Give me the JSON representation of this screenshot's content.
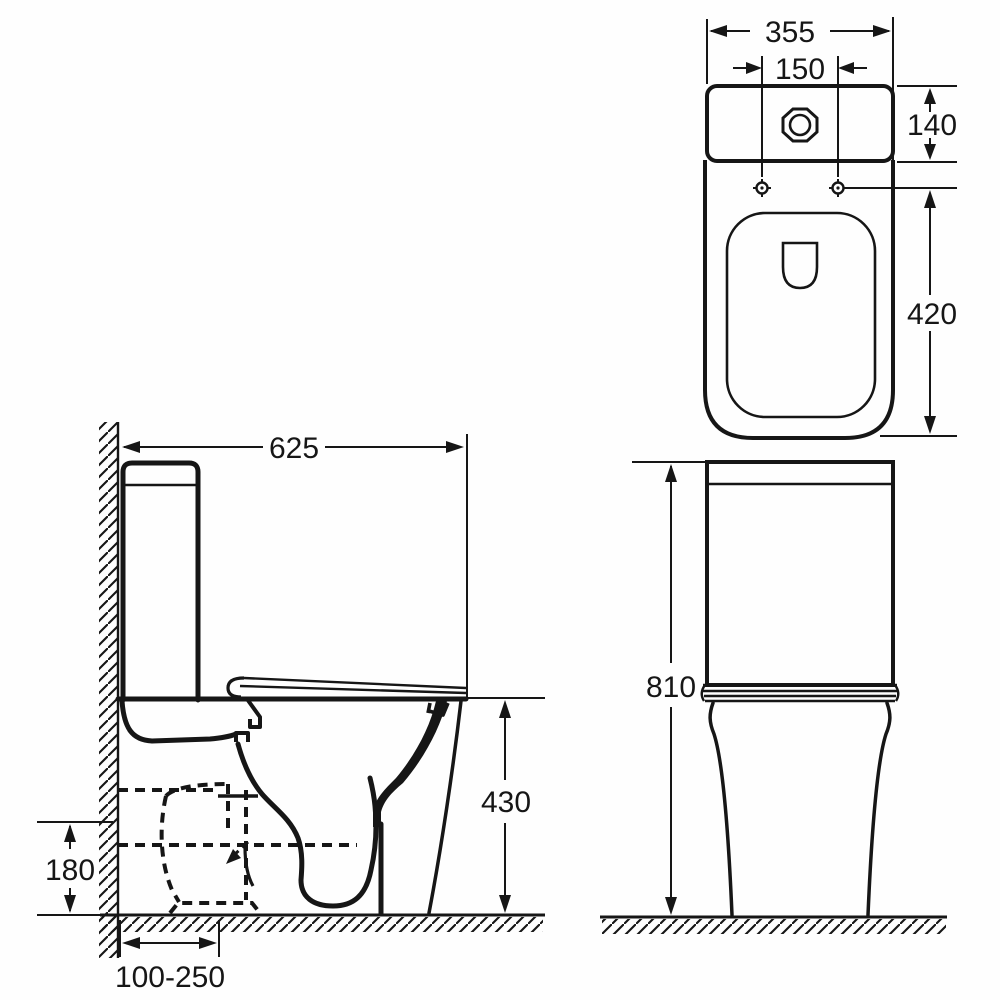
{
  "drawing": {
    "subject": "Close-coupled toilet technical dimension drawing (side view, plan view, front view)",
    "background": "#ffffff",
    "line_color": "#161616",
    "side_view": {
      "depth_mm": "625",
      "rim_height_mm": "430",
      "outlet_height_mm": "180",
      "outlet_offset_mm": "100-250"
    },
    "plan_view": {
      "width_mm": "355",
      "fixing_centres_mm": "150",
      "cistern_depth_mm": "140",
      "pan_length_mm": "420"
    },
    "front_view": {
      "height_mm": "810"
    }
  }
}
